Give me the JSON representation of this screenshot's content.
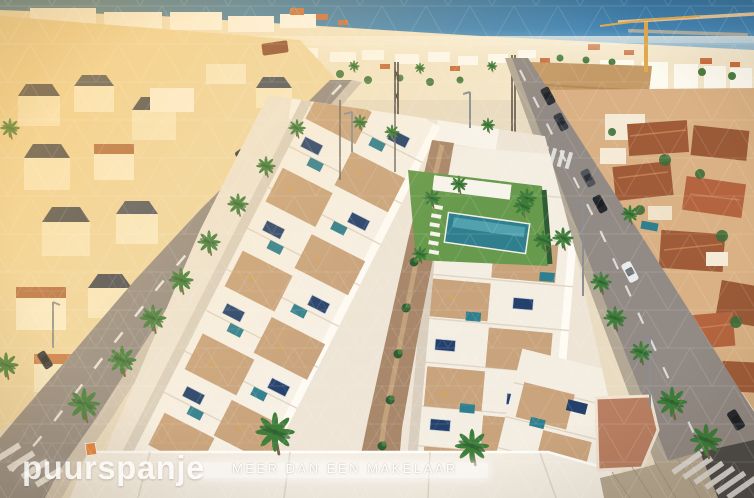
{
  "watermark": {
    "logo_text": "puurspanje",
    "tagline": "MEER DAN EEN MAKELAAR"
  },
  "scene": {
    "type": "aerial-photo",
    "description": "Aerial render of a new-build residential development with roof terraces, solar panels, plunge pools and a communal lawn pool, flanked by palm-lined streets, older golden villas left, terracotta-roofed houses right, construction crane and sea on the horizon",
    "colors": {
      "sea": "#3f86bb",
      "sand": "#c49a66",
      "lawn": "#679a4c",
      "pool": "#2f7f8f",
      "asphalt": "#928a84",
      "building_white": "#f7f2e8",
      "terrace_tan": "#c79f77",
      "walkway_tan": "#a8876a",
      "roof_terracotta": "#a05c38",
      "golden_town": "#f0d8a4",
      "solar_panel": "#24416b",
      "palm_green": "#3e7d3a",
      "palm_trunk": "#7a5c3e",
      "crane_yellow": "#e0a94e",
      "watermark_white": "#ffffff"
    }
  }
}
